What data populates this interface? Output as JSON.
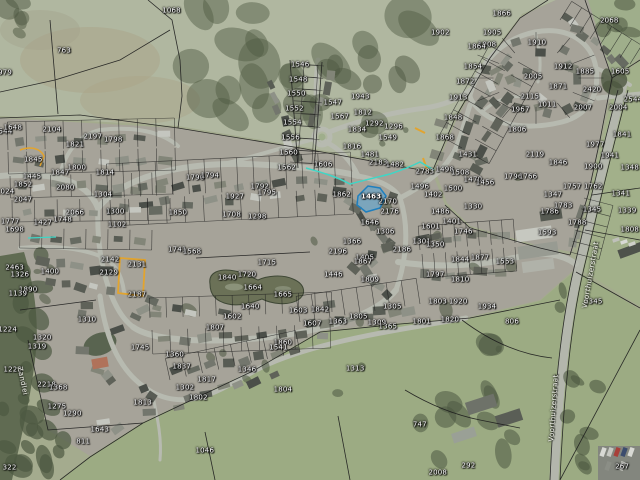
{
  "app": {
    "type": "aerial-cadastral-map-view"
  },
  "map": {
    "selected_parcel": {
      "id": "1463",
      "fill": "#57a8d8",
      "stroke": "#1f7fbe"
    },
    "highlight_colors": {
      "teal": "#3fd6c6",
      "yellow": "#e2a42f"
    },
    "label_color": "#ffffff",
    "street_labels": [
      {
        "text": "Voorthuizerstraat",
        "x": 92.4,
        "y": 57.3,
        "rot": -80
      },
      {
        "text": "Voorthuizerstraat",
        "x": 86.6,
        "y": 85.0,
        "rot": -86
      },
      {
        "text": "Zandlei",
        "x": 3.4,
        "y": 79.4,
        "rot": 78
      }
    ],
    "parcel_labels": [
      {
        "t": "1068",
        "x": 26.8,
        "y": 2.3
      },
      {
        "t": "763",
        "x": 10.0,
        "y": 10.6
      },
      {
        "t": "979",
        "x": 0.8,
        "y": 15.2
      },
      {
        "t": "1866",
        "x": 78.4,
        "y": 2.9
      },
      {
        "t": "2068",
        "x": 95.2,
        "y": 4.4
      },
      {
        "t": "1313",
        "x": 55.5,
        "y": 76.8
      },
      {
        "t": "1046",
        "x": 32.0,
        "y": 94.0
      },
      {
        "t": "747",
        "x": 65.6,
        "y": 88.6
      },
      {
        "t": "292",
        "x": 73.2,
        "y": 97.0
      },
      {
        "t": "811",
        "x": 13.0,
        "y": 92.0
      },
      {
        "t": "322",
        "x": 1.5,
        "y": 97.5
      },
      {
        "t": "267",
        "x": 97.2,
        "y": 97.3
      },
      {
        "t": "2008",
        "x": 68.4,
        "y": 98.5
      },
      {
        "t": "1544",
        "x": 0.5,
        "y": 27.5
      },
      {
        "t": "1546",
        "x": 46.9,
        "y": 13.5
      },
      {
        "t": "1548",
        "x": 46.6,
        "y": 16.6
      },
      {
        "t": "1550",
        "x": 46.3,
        "y": 19.6
      },
      {
        "t": "1552",
        "x": 46.0,
        "y": 22.7
      },
      {
        "t": "1554",
        "x": 45.7,
        "y": 25.7
      },
      {
        "t": "1556",
        "x": 45.4,
        "y": 28.8
      },
      {
        "t": "1560",
        "x": 45.1,
        "y": 31.9
      },
      {
        "t": "1562",
        "x": 44.8,
        "y": 34.9
      },
      {
        "t": "1902",
        "x": 68.8,
        "y": 6.9
      },
      {
        "t": "1905",
        "x": 76.9,
        "y": 6.9
      },
      {
        "t": "1908",
        "x": 76.1,
        "y": 9.4
      },
      {
        "t": "1910",
        "x": 83.9,
        "y": 9.0
      },
      {
        "t": "1864",
        "x": 74.5,
        "y": 9.8
      },
      {
        "t": "1854",
        "x": 73.9,
        "y": 13.9
      },
      {
        "t": "1872",
        "x": 72.7,
        "y": 17.0
      },
      {
        "t": "1913",
        "x": 71.6,
        "y": 20.5
      },
      {
        "t": "1848",
        "x": 70.8,
        "y": 24.6
      },
      {
        "t": "1868",
        "x": 69.5,
        "y": 28.8
      },
      {
        "t": "2005",
        "x": 83.3,
        "y": 16.0
      },
      {
        "t": "1912",
        "x": 88.0,
        "y": 13.9
      },
      {
        "t": "1885",
        "x": 91.4,
        "y": 15.0
      },
      {
        "t": "1605",
        "x": 96.9,
        "y": 15.0
      },
      {
        "t": "1871",
        "x": 87.2,
        "y": 18.1
      },
      {
        "t": "2420",
        "x": 92.5,
        "y": 18.8
      },
      {
        "t": "2544",
        "x": 98.9,
        "y": 20.8
      },
      {
        "t": "2115",
        "x": 82.8,
        "y": 20.2
      },
      {
        "t": "1011",
        "x": 85.5,
        "y": 21.9
      },
      {
        "t": "1967",
        "x": 81.3,
        "y": 22.9
      },
      {
        "t": "2007",
        "x": 91.1,
        "y": 22.5
      },
      {
        "t": "2004",
        "x": 96.6,
        "y": 22.5
      },
      {
        "t": "1806",
        "x": 80.8,
        "y": 27.1
      },
      {
        "t": "1841",
        "x": 97.2,
        "y": 28.1
      },
      {
        "t": "1977",
        "x": 93.0,
        "y": 30.2
      },
      {
        "t": "2119",
        "x": 83.6,
        "y": 32.3
      },
      {
        "t": "1846",
        "x": 87.2,
        "y": 34.0
      },
      {
        "t": "1900",
        "x": 92.7,
        "y": 34.8
      },
      {
        "t": "1941",
        "x": 95.3,
        "y": 32.6
      },
      {
        "t": "1348",
        "x": 98.4,
        "y": 35.0
      },
      {
        "t": "1943",
        "x": 56.3,
        "y": 20.2
      },
      {
        "t": "1812",
        "x": 56.7,
        "y": 23.5
      },
      {
        "t": "1834",
        "x": 55.8,
        "y": 27.1
      },
      {
        "t": "1816",
        "x": 55.0,
        "y": 30.6
      },
      {
        "t": "1549",
        "x": 60.6,
        "y": 28.8
      },
      {
        "t": "1567",
        "x": 53.1,
        "y": 24.4
      },
      {
        "t": "1292",
        "x": 58.5,
        "y": 25.8
      },
      {
        "t": "1296",
        "x": 61.5,
        "y": 26.5
      },
      {
        "t": "1547",
        "x": 52.0,
        "y": 21.5
      },
      {
        "t": "1606",
        "x": 50.5,
        "y": 34.4
      },
      {
        "t": "1481",
        "x": 57.8,
        "y": 32.3
      },
      {
        "t": "2183",
        "x": 59.1,
        "y": 34.0
      },
      {
        "t": "1482",
        "x": 61.7,
        "y": 34.4
      },
      {
        "t": "2783",
        "x": 66.4,
        "y": 35.8
      },
      {
        "t": "1498",
        "x": 69.5,
        "y": 35.4
      },
      {
        "t": "1508",
        "x": 71.9,
        "y": 36.0
      },
      {
        "t": "1470",
        "x": 73.9,
        "y": 37.5
      },
      {
        "t": "1456",
        "x": 75.8,
        "y": 38.1
      },
      {
        "t": "1500",
        "x": 70.8,
        "y": 39.4
      },
      {
        "t": "1496",
        "x": 65.6,
        "y": 38.9
      },
      {
        "t": "1862",
        "x": 53.4,
        "y": 40.6
      },
      {
        "t": "1402",
        "x": 67.7,
        "y": 40.6
      },
      {
        "t": "2170",
        "x": 60.6,
        "y": 42.0
      },
      {
        "t": "2176",
        "x": 60.9,
        "y": 44.1
      },
      {
        "t": "1486",
        "x": 68.8,
        "y": 44.1
      },
      {
        "t": "1330",
        "x": 73.9,
        "y": 43.1
      },
      {
        "t": "1401",
        "x": 70.6,
        "y": 46.2
      },
      {
        "t": "1746",
        "x": 72.4,
        "y": 48.3
      },
      {
        "t": "1646",
        "x": 57.8,
        "y": 46.5
      },
      {
        "t": "1306",
        "x": 60.2,
        "y": 48.3
      },
      {
        "t": "2186",
        "x": 62.8,
        "y": 52.1
      },
      {
        "t": "1301",
        "x": 65.9,
        "y": 50.4
      },
      {
        "t": "1366",
        "x": 55.0,
        "y": 50.4
      },
      {
        "t": "1405",
        "x": 57.0,
        "y": 53.8
      },
      {
        "t": "1431",
        "x": 73.1,
        "y": 32.3
      },
      {
        "t": "1601",
        "x": 67.3,
        "y": 47.2
      },
      {
        "t": "1463",
        "x": 58.0,
        "y": 41.0,
        "sel": true
      },
      {
        "t": "1796",
        "x": 80.2,
        "y": 36.9
      },
      {
        "t": "1766",
        "x": 82.5,
        "y": 36.9
      },
      {
        "t": "1757",
        "x": 89.4,
        "y": 39.0
      },
      {
        "t": "1347",
        "x": 86.4,
        "y": 40.6
      },
      {
        "t": "1762",
        "x": 92.7,
        "y": 39.0
      },
      {
        "t": "1786",
        "x": 85.9,
        "y": 44.2
      },
      {
        "t": "1788",
        "x": 90.2,
        "y": 46.5
      },
      {
        "t": "1783",
        "x": 88.0,
        "y": 43.0
      },
      {
        "t": "1593",
        "x": 85.5,
        "y": 48.5
      },
      {
        "t": "1345",
        "x": 92.5,
        "y": 43.8
      },
      {
        "t": "1808",
        "x": 98.4,
        "y": 47.9
      },
      {
        "t": "1341",
        "x": 97.0,
        "y": 40.5
      },
      {
        "t": "1339",
        "x": 98.0,
        "y": 44.0
      },
      {
        "t": "2196",
        "x": 52.8,
        "y": 52.5
      },
      {
        "t": "1446",
        "x": 52.1,
        "y": 57.3
      },
      {
        "t": "1867",
        "x": 56.7,
        "y": 54.6
      },
      {
        "t": "1809",
        "x": 57.8,
        "y": 58.3
      },
      {
        "t": "1350",
        "x": 68.0,
        "y": 51.0
      },
      {
        "t": "1797",
        "x": 68.0,
        "y": 57.3
      },
      {
        "t": "1844",
        "x": 71.9,
        "y": 54.2
      },
      {
        "t": "1877",
        "x": 75.0,
        "y": 53.8
      },
      {
        "t": "1553",
        "x": 78.9,
        "y": 54.6
      },
      {
        "t": "1810",
        "x": 71.9,
        "y": 58.3
      },
      {
        "t": "1803",
        "x": 68.4,
        "y": 62.9
      },
      {
        "t": "1920",
        "x": 71.6,
        "y": 62.9
      },
      {
        "t": "1934",
        "x": 76.1,
        "y": 64.0
      },
      {
        "t": "1801",
        "x": 65.9,
        "y": 67.1
      },
      {
        "t": "1820",
        "x": 70.3,
        "y": 66.7
      },
      {
        "t": "806",
        "x": 80.0,
        "y": 67.1
      },
      {
        "t": "2345",
        "x": 92.7,
        "y": 62.9
      },
      {
        "t": "1860",
        "x": 44.2,
        "y": 71.5
      },
      {
        "t": "1363",
        "x": 52.8,
        "y": 67.1
      },
      {
        "t": "1805",
        "x": 56.0,
        "y": 66.0
      },
      {
        "t": "1309",
        "x": 58.9,
        "y": 67.3
      },
      {
        "t": "1365",
        "x": 60.6,
        "y": 68.1
      },
      {
        "t": "1305",
        "x": 61.3,
        "y": 64.0
      },
      {
        "t": "1603",
        "x": 46.6,
        "y": 64.8
      },
      {
        "t": "1607",
        "x": 48.8,
        "y": 67.5
      },
      {
        "t": "1842",
        "x": 50.0,
        "y": 64.6
      },
      {
        "t": "1664",
        "x": 39.5,
        "y": 60.0
      },
      {
        "t": "1840",
        "x": 35.5,
        "y": 57.9
      },
      {
        "t": "1720",
        "x": 38.6,
        "y": 57.3
      },
      {
        "t": "1715",
        "x": 41.7,
        "y": 54.8
      },
      {
        "t": "1665",
        "x": 44.2,
        "y": 61.5
      },
      {
        "t": "1640",
        "x": 39.1,
        "y": 64.0
      },
      {
        "t": "1602",
        "x": 36.3,
        "y": 66.0
      },
      {
        "t": "1648",
        "x": 2.0,
        "y": 26.7
      },
      {
        "t": "2104",
        "x": 8.1,
        "y": 27.1
      },
      {
        "t": "1821",
        "x": 11.7,
        "y": 30.2
      },
      {
        "t": "2197",
        "x": 14.5,
        "y": 28.5
      },
      {
        "t": "1798",
        "x": 17.7,
        "y": 29.2
      },
      {
        "t": "1845",
        "x": 5.2,
        "y": 33.3
      },
      {
        "t": "1445",
        "x": 5.0,
        "y": 36.9
      },
      {
        "t": "1852",
        "x": 3.6,
        "y": 38.5
      },
      {
        "t": "1024",
        "x": 0.8,
        "y": 40.0
      },
      {
        "t": "2047",
        "x": 3.6,
        "y": 41.7
      },
      {
        "t": "1847",
        "x": 9.4,
        "y": 36.0
      },
      {
        "t": "2080",
        "x": 10.2,
        "y": 39.2
      },
      {
        "t": "1800",
        "x": 12.0,
        "y": 35.0
      },
      {
        "t": "1814",
        "x": 16.4,
        "y": 36.0
      },
      {
        "t": "1304",
        "x": 16.1,
        "y": 40.6
      },
      {
        "t": "2066",
        "x": 11.7,
        "y": 44.4
      },
      {
        "t": "1748",
        "x": 9.8,
        "y": 45.8
      },
      {
        "t": "1427",
        "x": 6.7,
        "y": 46.5
      },
      {
        "t": "1777",
        "x": 1.6,
        "y": 46.2
      },
      {
        "t": "1698",
        "x": 2.3,
        "y": 47.9
      },
      {
        "t": "1300",
        "x": 18.0,
        "y": 44.1
      },
      {
        "t": "1102",
        "x": 18.3,
        "y": 46.9
      },
      {
        "t": "1790",
        "x": 30.5,
        "y": 37.1
      },
      {
        "t": "1794",
        "x": 32.8,
        "y": 36.7
      },
      {
        "t": "1792",
        "x": 40.6,
        "y": 38.9
      },
      {
        "t": "1795",
        "x": 41.7,
        "y": 40.2
      },
      {
        "t": "1927",
        "x": 36.7,
        "y": 41.0
      },
      {
        "t": "1708",
        "x": 36.2,
        "y": 44.8
      },
      {
        "t": "1298",
        "x": 40.2,
        "y": 45.2
      },
      {
        "t": "1850",
        "x": 27.8,
        "y": 44.4
      },
      {
        "t": "1741",
        "x": 27.7,
        "y": 52.1
      },
      {
        "t": "1568",
        "x": 30.0,
        "y": 52.5
      },
      {
        "t": "2142",
        "x": 17.2,
        "y": 54.2
      },
      {
        "t": "2131",
        "x": 21.4,
        "y": 55.2
      },
      {
        "t": "2129",
        "x": 17.0,
        "y": 56.9
      },
      {
        "t": "2187",
        "x": 21.4,
        "y": 61.5
      },
      {
        "t": "2463",
        "x": 2.3,
        "y": 55.8
      },
      {
        "t": "1326",
        "x": 3.1,
        "y": 57.3
      },
      {
        "t": "1890",
        "x": 4.4,
        "y": 60.4
      },
      {
        "t": "1400",
        "x": 7.8,
        "y": 56.7
      },
      {
        "t": "1310",
        "x": 13.6,
        "y": 66.7
      },
      {
        "t": "1320",
        "x": 6.6,
        "y": 70.4
      },
      {
        "t": "1319",
        "x": 5.8,
        "y": 72.3
      },
      {
        "t": "1139",
        "x": 2.8,
        "y": 61.3
      },
      {
        "t": "1224",
        "x": 1.2,
        "y": 68.8
      },
      {
        "t": "1223",
        "x": 2.0,
        "y": 77.1
      },
      {
        "t": "2218",
        "x": 7.3,
        "y": 80.2
      },
      {
        "t": "1368",
        "x": 9.1,
        "y": 80.8
      },
      {
        "t": "1275",
        "x": 8.9,
        "y": 84.8
      },
      {
        "t": "1290",
        "x": 11.3,
        "y": 86.3
      },
      {
        "t": "1643",
        "x": 15.6,
        "y": 89.6
      },
      {
        "t": "1745",
        "x": 21.9,
        "y": 72.5
      },
      {
        "t": "1360",
        "x": 27.3,
        "y": 74.0
      },
      {
        "t": "1837",
        "x": 28.4,
        "y": 76.5
      },
      {
        "t": "1817",
        "x": 32.3,
        "y": 79.2
      },
      {
        "t": "1302",
        "x": 28.9,
        "y": 80.9
      },
      {
        "t": "1804",
        "x": 44.2,
        "y": 81.3
      },
      {
        "t": "1813",
        "x": 22.3,
        "y": 84.0
      },
      {
        "t": "1802",
        "x": 31.0,
        "y": 82.9
      },
      {
        "t": "1346",
        "x": 38.6,
        "y": 77.1
      },
      {
        "t": "1541",
        "x": 43.5,
        "y": 72.5
      },
      {
        "t": "1807",
        "x": 33.6,
        "y": 68.3
      }
    ]
  }
}
